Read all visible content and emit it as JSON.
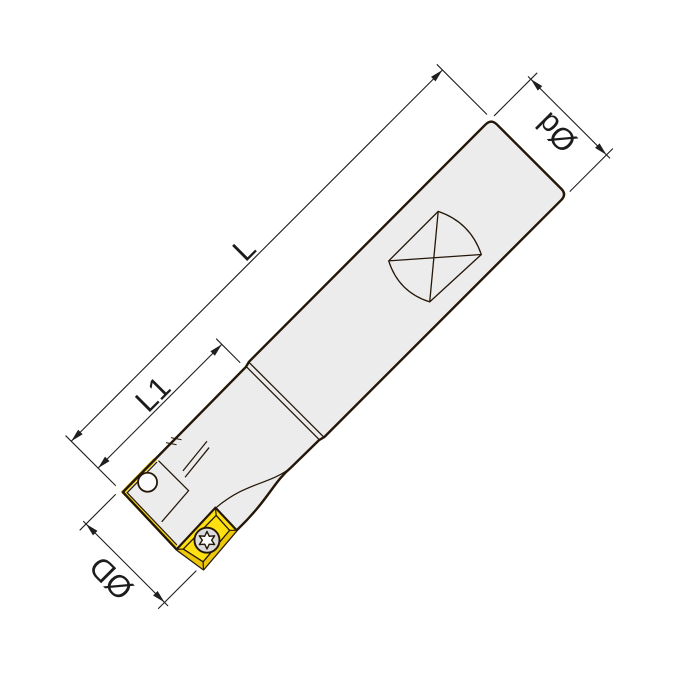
{
  "figure": {
    "type": "technical-dimension-drawing",
    "subject": "indexable end mill with screw-on carbide insert, shown at 45 degrees"
  },
  "dimensions": {
    "overall_length": {
      "label": "L"
    },
    "head_length": {
      "label": "L1"
    },
    "shank_diameter": {
      "label": "Ød"
    },
    "cutting_diameter": {
      "label": "ØD"
    }
  },
  "colors": {
    "background": "#ffffff",
    "body_fill": "#ececec",
    "outline": "#241708",
    "dimension_lines": "#1f1f1f",
    "insert_fill": "#ffe112",
    "insert_shadow": "#ecc70a",
    "hole_fill": "#fbfbfb",
    "screw_fill": "#dcdcdc",
    "screw_star": "#ffffff"
  }
}
